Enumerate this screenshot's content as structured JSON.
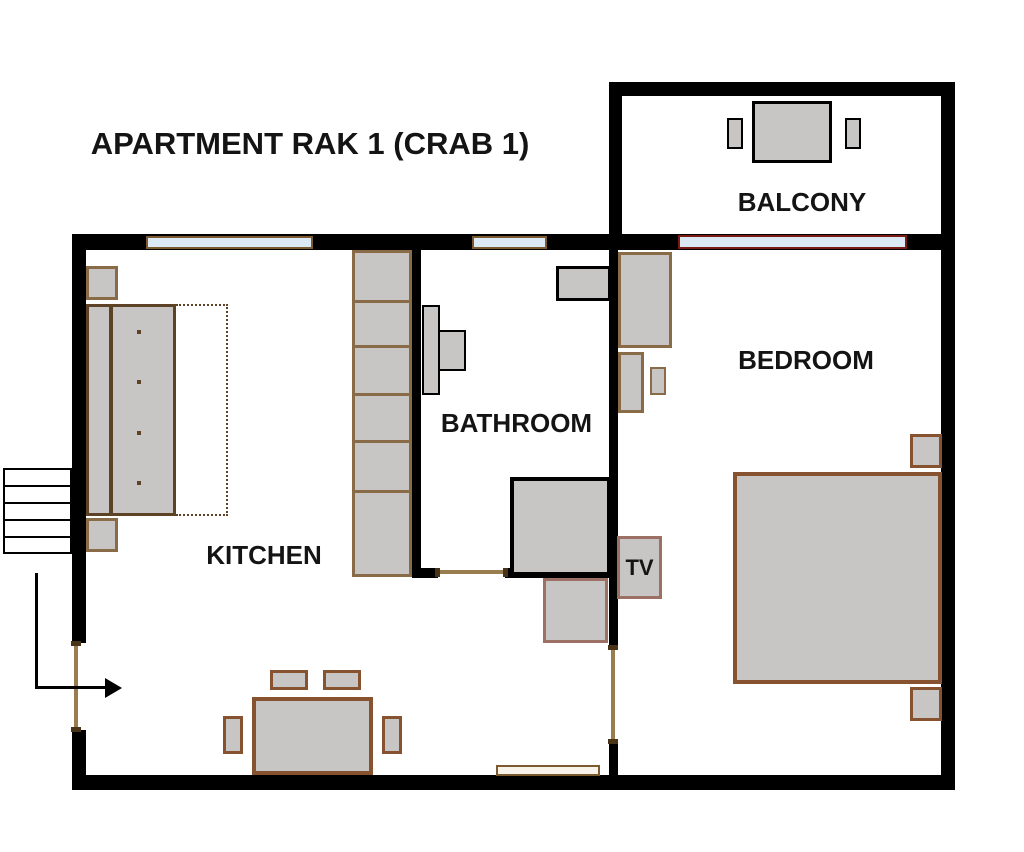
{
  "title": "APARTMENT RAK 1 (CRAB 1)",
  "labels": {
    "balcony": "BALCONY",
    "bedroom": "BEDROOM",
    "bathroom": "BATHROOM",
    "kitchen": "KITCHEN",
    "tv": "TV"
  },
  "colors": {
    "wall": "#000000",
    "furn_fill": "#c8c6c4",
    "border_dark": "#5d4226",
    "border_tan": "#8a6b47",
    "border_brown": "#86522f",
    "border_red": "#9c7064",
    "door_line": "#9a7d4e",
    "door_cap": "#4a3418",
    "window_fill": "#dbe9f5",
    "window_border_tan": "#7a5a2e",
    "window_border_red": "#7a1a14",
    "radiator_fill": "#f7f3ea",
    "text": "#141414"
  }
}
